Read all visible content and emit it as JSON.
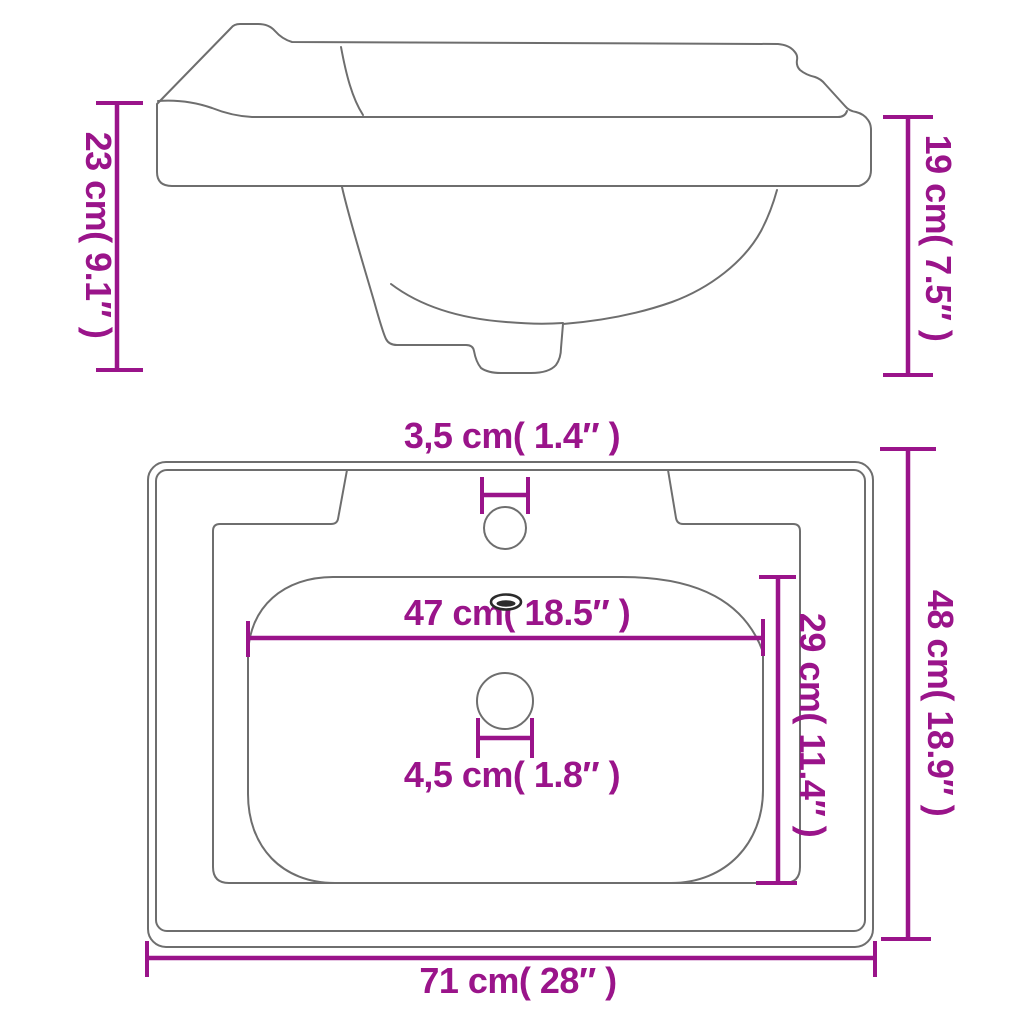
{
  "colors": {
    "accent": "#9A148A",
    "outline": "#6E6E6E",
    "hole_detail": "#2B2B2B",
    "background": "#FFFFFF"
  },
  "diagram": {
    "subject": "rectangular bathroom sink dimension drawing",
    "views": [
      "side-view",
      "top-view"
    ],
    "labels": {
      "height_left": "23 cm( 9.1″ )",
      "height_right": "19 cm( 7.5″ )",
      "faucet_hole_width": "3,5 cm( 1.4″ )",
      "basin_width": "47 cm( 18.5″ )",
      "basin_depth": "29 cm( 11.4″ )",
      "drain_hole_width": "4,5 cm( 1.8″ )",
      "overall_depth": "48 cm( 18.9″ )",
      "overall_width": "71 cm( 28″ )"
    },
    "measurements": [
      {
        "name": "back height",
        "cm": "23",
        "inch": "9.1"
      },
      {
        "name": "front height",
        "cm": "19",
        "inch": "7.5"
      },
      {
        "name": "faucet hole diameter",
        "cm": "3,5",
        "inch": "1.4"
      },
      {
        "name": "inner basin width",
        "cm": "47",
        "inch": "18.5"
      },
      {
        "name": "inner basin depth",
        "cm": "29",
        "inch": "11.4"
      },
      {
        "name": "drain hole diameter",
        "cm": "4,5",
        "inch": "1.8"
      },
      {
        "name": "overall depth",
        "cm": "48",
        "inch": "18.9"
      },
      {
        "name": "overall width",
        "cm": "71",
        "inch": "28"
      }
    ]
  }
}
